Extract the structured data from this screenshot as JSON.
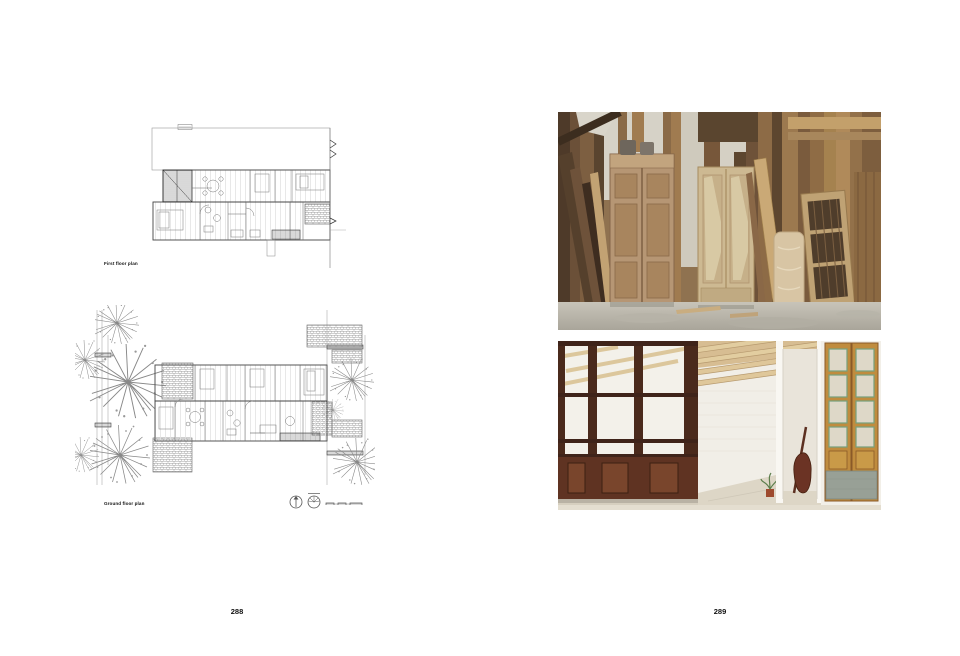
{
  "book": {
    "left_page": {
      "page_number": "288",
      "plan_captions": {
        "first_floor": "First floor plan",
        "ground_floor": "Ground floor plan"
      }
    },
    "right_page": {
      "page_number": "289"
    }
  }
}
